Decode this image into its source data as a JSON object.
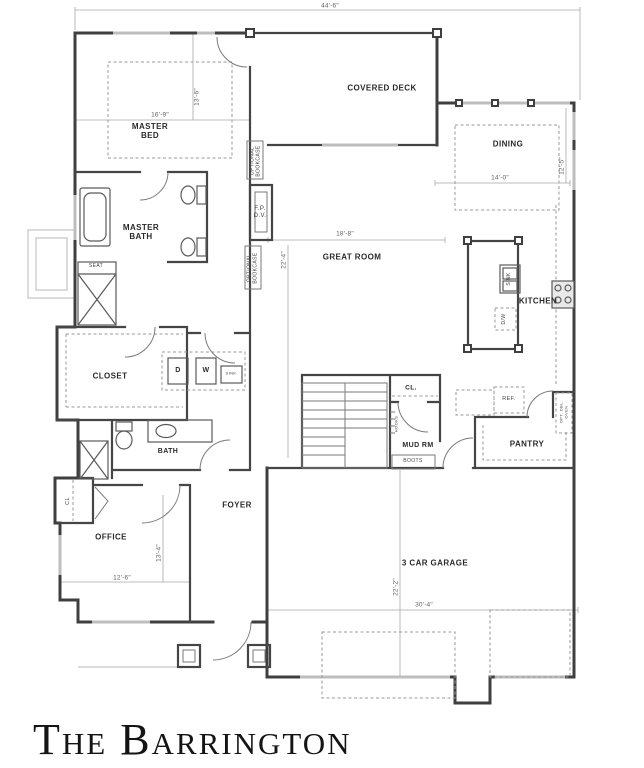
{
  "plan_title": "The Barrington",
  "rooms": {
    "master_bed": "MASTER BED",
    "master_bath": "MASTER BATH",
    "covered_deck": "COVERED DECK",
    "dining": "DINING",
    "great_room": "GREAT ROOM",
    "kitchen": "KITCHEN",
    "closet": "CLOSET",
    "bath": "BATH",
    "foyer": "FOYER",
    "office": "OFFICE",
    "office_closet": "CL",
    "mud_room": "MUD RM",
    "mud_closet": "CL.",
    "pantry": "PANTRY",
    "garage": "3 CAR GARAGE"
  },
  "labels": {
    "seat": "SEAT",
    "dryer": "D",
    "washer": "W",
    "laundry_sink": "SINK",
    "island_sink": "SINK",
    "dishwasher": "D/W",
    "fridge": "REF.",
    "fp_line1": "F.P.",
    "fp_line2": "D.V.",
    "boots": "BOOTS",
    "hooks": "HOOKS",
    "optional_bookcase": "OPTIONAL BOOKCASE",
    "opt_double_oven": "OPT. DBL. OVEN"
  },
  "dims": {
    "overall_width": "44'-6\"",
    "master_bed_width": "16'-9\"",
    "master_bed_depth": "13'-6\"",
    "great_room_width": "18'-8\"",
    "great_room_depth": "22'-4\"",
    "dining_width": "14'-0\"",
    "dining_depth": "12'-5\"",
    "office_width": "12'-6\"",
    "office_depth": "13'-4\"",
    "garage_width": "30'-4\"",
    "garage_depth": "22'-2\""
  }
}
